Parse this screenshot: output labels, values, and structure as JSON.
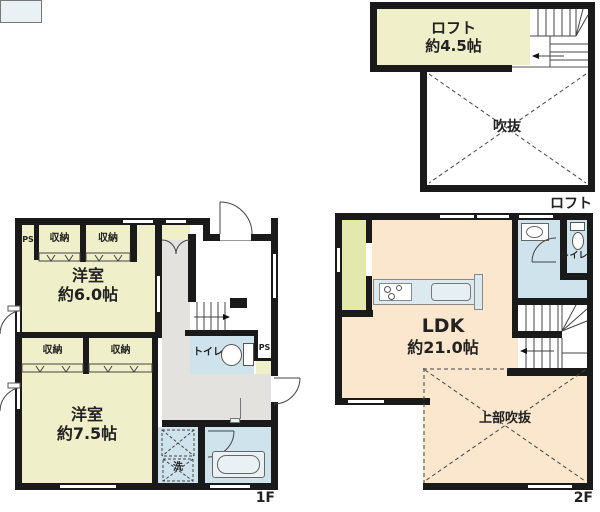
{
  "plan_type": "floor-plan",
  "colors": {
    "wall": "#1a1a1a",
    "room_green": "#eff0c9",
    "closet_green": "#e3e8ad",
    "ldk_peach": "#fbe7cd",
    "wet_area_blue": "#cfe3ec",
    "hallway_gray": "#e3e2df",
    "fixture_blue": "#e9f1f5"
  },
  "loft": {
    "floor_label": "ロフト",
    "room_name": "ロフト",
    "room_size": "約4.5帖",
    "void_label": "吹抜"
  },
  "f1": {
    "floor_label": "1F",
    "ps_left": "PS",
    "ps_right": "PS",
    "closet_a": "収納",
    "closet_b": "収納",
    "closet_c": "収納",
    "closet_d": "収納",
    "room_a_name": "洋室",
    "room_a_size": "約6.0帖",
    "room_b_name": "洋室",
    "room_b_size": "約7.5帖",
    "toilet_label": "トイレ",
    "laundry_label": "洗"
  },
  "f2": {
    "floor_label": "2F",
    "ldk_name": "LDK",
    "ldk_size": "約21.0帖",
    "toilet_label": "トイレ",
    "void_label": "上部吹抜"
  }
}
